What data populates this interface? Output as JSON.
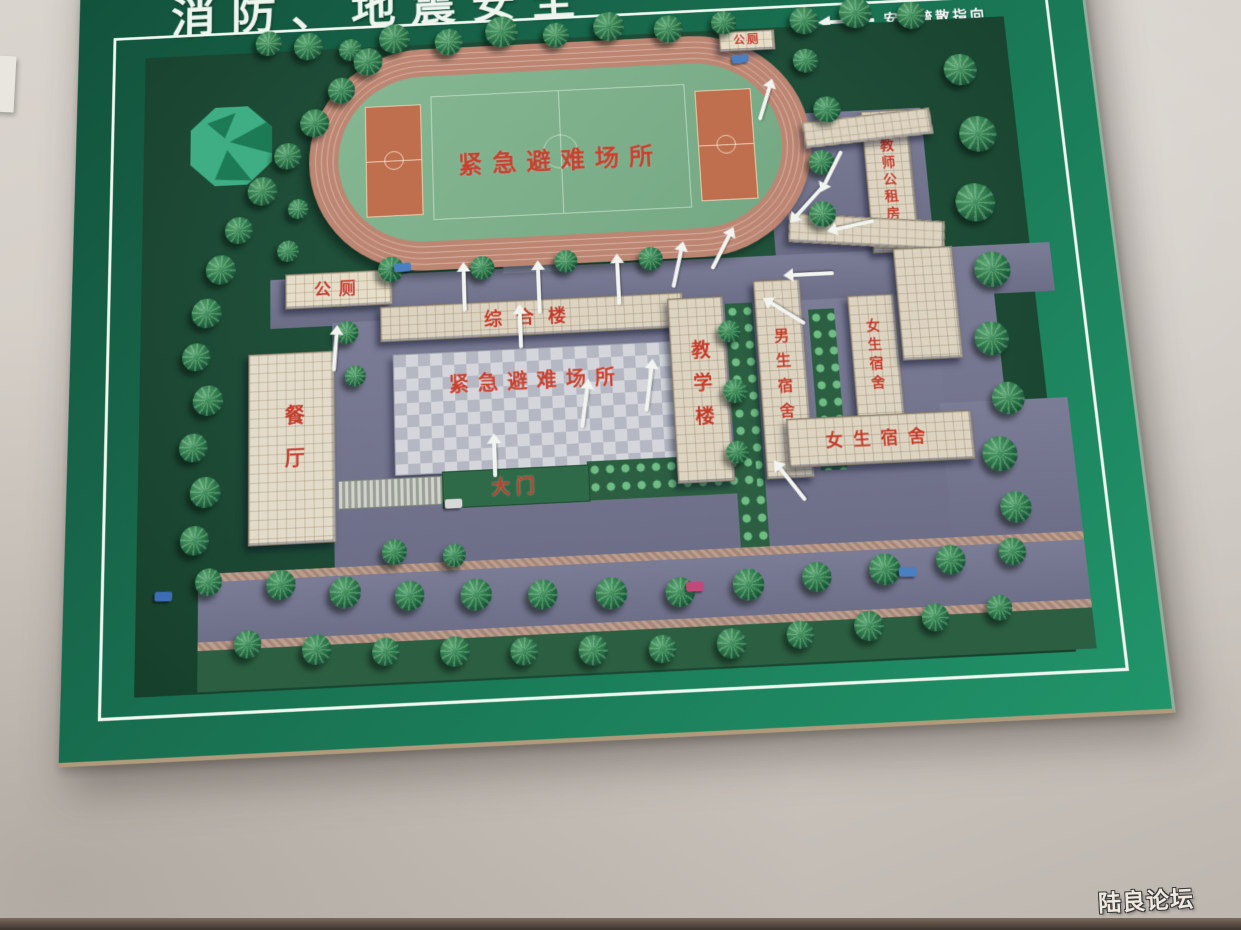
{
  "board": {
    "title": "消防、地震安全",
    "legend_label": "安全疏散指向"
  },
  "map": {
    "field_shelter_label": "紧急避难场所",
    "plaza_shelter_label": "紧急避难场所",
    "buildings": {
      "toilet_top": "公厕",
      "toilet_left": "公厕",
      "comprehensive_building": "综合楼",
      "teaching_building": "教学楼",
      "boys_dormitory": "男生宿舍",
      "girls_dormitory_side": "女生宿舍",
      "girls_dormitory_bottom": "女生宿舍",
      "teachers_public_rental_housing": "教师公租房",
      "dining_hall": "餐厅",
      "main_gate": "大门"
    },
    "colors": {
      "board_green": "#1a7a57",
      "map_green": "#1e4c37",
      "track": "#bd8673",
      "field_green": "#7db08d",
      "court_orange": "#bf6f4e",
      "road_purple": "#74758f",
      "building_beige": "#dcd3c0",
      "label_red": "#c23a28",
      "arrow_white": "#f2f4f0"
    }
  },
  "photo": {
    "watermark": "陆良论坛"
  }
}
